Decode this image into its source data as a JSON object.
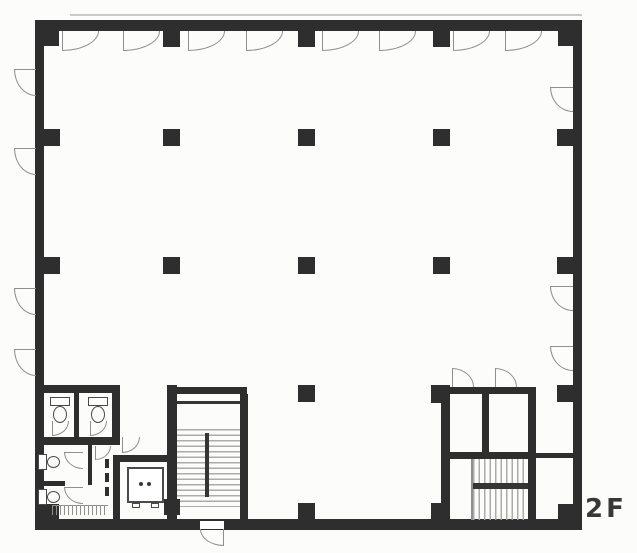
{
  "floor_label": "2F",
  "drawing": {
    "type": "architectural-floor-plan",
    "floor_name": "2F (second floor)",
    "features": [
      "open-office-area",
      "column-grid",
      "window-swing-arcs",
      "toilet-block",
      "elevator",
      "central-stairwell-with-exit",
      "rear-stair-core"
    ]
  },
  "colors": {
    "wall": "#2e2e2e",
    "dark": "#353535",
    "line": "#8f8f8f",
    "faint": "#c9c9c9",
    "tread": "#ababab",
    "white": "#ffffff"
  },
  "plan": {
    "elements": [
      {
        "t": "line",
        "name": "parapet-line",
        "x": 70,
        "y": 14,
        "w": 512,
        "h": 2,
        "c": "faint"
      },
      {
        "t": "rect",
        "name": "wall-top",
        "x": 35,
        "y": 20,
        "w": 547,
        "h": 11
      },
      {
        "t": "rect",
        "name": "wall-left",
        "x": 35,
        "y": 20,
        "w": 9,
        "h": 510
      },
      {
        "t": "rect",
        "name": "wall-right",
        "x": 573,
        "y": 20,
        "w": 9,
        "h": 510
      },
      {
        "t": "rect",
        "name": "wall-bottom",
        "x": 35,
        "y": 519,
        "w": 547,
        "h": 11
      },
      {
        "t": "rect",
        "name": "column-corner-nw",
        "x": 44,
        "y": 31,
        "w": 15,
        "h": 15
      },
      {
        "t": "rect",
        "name": "column-corner-ne",
        "x": 558,
        "y": 31,
        "w": 15,
        "h": 15
      },
      {
        "t": "rect",
        "name": "column-corner-sw",
        "x": 44,
        "y": 504,
        "w": 15,
        "h": 15
      },
      {
        "t": "rect",
        "name": "column-corner-se",
        "x": 558,
        "y": 504,
        "w": 15,
        "h": 15
      },
      {
        "t": "rect",
        "name": "column-top-1",
        "x": 163,
        "y": 31,
        "w": 17,
        "h": 16
      },
      {
        "t": "rect",
        "name": "column-top-2",
        "x": 298,
        "y": 31,
        "w": 17,
        "h": 16
      },
      {
        "t": "rect",
        "name": "column-top-3",
        "x": 433,
        "y": 31,
        "w": 17,
        "h": 16
      },
      {
        "t": "rect",
        "name": "column-left-1",
        "x": 44,
        "y": 129,
        "w": 16,
        "h": 17
      },
      {
        "t": "rect",
        "name": "column-left-2",
        "x": 44,
        "y": 257,
        "w": 16,
        "h": 17
      },
      {
        "t": "rect",
        "name": "column-right-1",
        "x": 557,
        "y": 129,
        "w": 16,
        "h": 17
      },
      {
        "t": "rect",
        "name": "column-right-2",
        "x": 557,
        "y": 257,
        "w": 16,
        "h": 17
      },
      {
        "t": "rect",
        "name": "column-right-3",
        "x": 557,
        "y": 385,
        "w": 16,
        "h": 17
      },
      {
        "t": "rect",
        "name": "column-bottom-1",
        "x": 298,
        "y": 503,
        "w": 17,
        "h": 16
      },
      {
        "t": "rect",
        "name": "column-interior",
        "x": 163,
        "y": 129,
        "w": 17,
        "h": 17
      },
      {
        "t": "rect",
        "name": "column-interior",
        "x": 298,
        "y": 129,
        "w": 17,
        "h": 17
      },
      {
        "t": "rect",
        "name": "column-interior",
        "x": 433,
        "y": 129,
        "w": 17,
        "h": 17
      },
      {
        "t": "rect",
        "name": "column-interior",
        "x": 163,
        "y": 257,
        "w": 17,
        "h": 17
      },
      {
        "t": "rect",
        "name": "column-interior",
        "x": 298,
        "y": 257,
        "w": 17,
        "h": 17
      },
      {
        "t": "rect",
        "name": "column-interior",
        "x": 433,
        "y": 257,
        "w": 17,
        "h": 17
      },
      {
        "t": "rect",
        "name": "column-interior",
        "x": 298,
        "y": 385,
        "w": 17,
        "h": 17
      },
      {
        "t": "arc",
        "name": "window-arc-top",
        "corner": "br",
        "leaf": "left",
        "x": 62,
        "y": 31,
        "w": 37,
        "h": 20
      },
      {
        "t": "arc",
        "name": "window-arc-top",
        "corner": "br",
        "leaf": "left",
        "x": 123,
        "y": 31,
        "w": 37,
        "h": 20
      },
      {
        "t": "arc",
        "name": "window-arc-top",
        "corner": "br",
        "leaf": "left",
        "x": 188,
        "y": 31,
        "w": 37,
        "h": 20
      },
      {
        "t": "arc",
        "name": "window-arc-top",
        "corner": "br",
        "leaf": "left",
        "x": 246,
        "y": 31,
        "w": 37,
        "h": 20
      },
      {
        "t": "arc",
        "name": "window-arc-top",
        "corner": "br",
        "leaf": "left",
        "x": 322,
        "y": 31,
        "w": 37,
        "h": 20
      },
      {
        "t": "arc",
        "name": "window-arc-top",
        "corner": "br",
        "leaf": "left",
        "x": 379,
        "y": 31,
        "w": 37,
        "h": 20
      },
      {
        "t": "arc",
        "name": "window-arc-top",
        "corner": "br",
        "leaf": "left",
        "x": 453,
        "y": 31,
        "w": 37,
        "h": 20
      },
      {
        "t": "arc",
        "name": "window-arc-top",
        "corner": "br",
        "leaf": "left",
        "x": 505,
        "y": 31,
        "w": 37,
        "h": 20
      },
      {
        "t": "arc",
        "name": "window-arc-left",
        "corner": "bl",
        "leaf": "top",
        "x": 14,
        "y": 69,
        "w": 22,
        "h": 27
      },
      {
        "t": "arc",
        "name": "window-arc-left",
        "corner": "bl",
        "leaf": "top",
        "x": 14,
        "y": 148,
        "w": 22,
        "h": 27
      },
      {
        "t": "arc",
        "name": "window-arc-left",
        "corner": "bl",
        "leaf": "top",
        "x": 14,
        "y": 288,
        "w": 22,
        "h": 27
      },
      {
        "t": "arc",
        "name": "window-arc-left",
        "corner": "bl",
        "leaf": "top",
        "x": 14,
        "y": 349,
        "w": 22,
        "h": 27
      },
      {
        "t": "arc",
        "name": "window-arc-right",
        "corner": "bl",
        "leaf": "top",
        "x": 550,
        "y": 87,
        "w": 23,
        "h": 25
      },
      {
        "t": "arc",
        "name": "window-arc-right",
        "corner": "bl",
        "leaf": "top",
        "x": 550,
        "y": 286,
        "w": 23,
        "h": 25
      },
      {
        "t": "arc",
        "name": "window-arc-right",
        "corner": "bl",
        "leaf": "top",
        "x": 550,
        "y": 346,
        "w": 23,
        "h": 25
      },
      {
        "t": "rect",
        "name": "stair-wall-left",
        "x": 167,
        "y": 385,
        "w": 10,
        "h": 145
      },
      {
        "t": "rect",
        "name": "stair-wall-top",
        "x": 177,
        "y": 387,
        "w": 70,
        "h": 7
      },
      {
        "t": "rect",
        "name": "stair-wall-right",
        "x": 240,
        "y": 394,
        "w": 8,
        "h": 136
      },
      {
        "t": "rect",
        "name": "stair-landing-edge",
        "x": 177,
        "y": 401,
        "w": 63,
        "h": 3,
        "c": "dark"
      },
      {
        "t": "hlines",
        "name": "stair-treads",
        "x": 177,
        "y": 429,
        "w": 63,
        "h": 78
      },
      {
        "t": "rect",
        "name": "stair-center-rail",
        "x": 205,
        "y": 433,
        "w": 4,
        "h": 64,
        "c": "dark"
      },
      {
        "t": "rect",
        "name": "column-stair-sw",
        "x": 164,
        "y": 499,
        "w": 16,
        "h": 16
      },
      {
        "t": "rect",
        "name": "exit-door-opening",
        "x": 200,
        "y": 521,
        "w": 24,
        "h": 8,
        "c": "white"
      },
      {
        "t": "arc",
        "name": "exit-door-arc",
        "corner": "bl",
        "leaf": "right",
        "x": 200,
        "y": 529,
        "w": 24,
        "h": 17
      },
      {
        "t": "rect",
        "name": "elevator-wall-top",
        "x": 113,
        "y": 455,
        "w": 54,
        "h": 7
      },
      {
        "t": "rect",
        "name": "elevator-wall-left",
        "x": 113,
        "y": 455,
        "w": 7,
        "h": 75
      },
      {
        "t": "box",
        "name": "elevator-car",
        "x": 127,
        "y": 467,
        "w": 37,
        "h": 36,
        "bw": 2
      },
      {
        "t": "dot",
        "name": "elevator-dot",
        "x": 139,
        "y": 482,
        "w": 4,
        "h": 4
      },
      {
        "t": "dot",
        "name": "elevator-dot",
        "x": 147,
        "y": 482,
        "w": 4,
        "h": 4
      },
      {
        "t": "box",
        "name": "elevator-door-jamb",
        "x": 132,
        "y": 503,
        "w": 8,
        "h": 5
      },
      {
        "t": "box",
        "name": "elevator-door-jamb",
        "x": 151,
        "y": 503,
        "w": 8,
        "h": 5
      },
      {
        "t": "arc",
        "name": "elevator-lobby-door",
        "corner": "br",
        "leaf": "left",
        "x": 122,
        "y": 437,
        "w": 18,
        "h": 16
      },
      {
        "t": "rect",
        "name": "toilet-wall-top",
        "x": 35,
        "y": 385,
        "w": 85,
        "h": 8
      },
      {
        "t": "rect",
        "name": "toilet-wall-right",
        "x": 112,
        "y": 385,
        "w": 8,
        "h": 60
      },
      {
        "t": "rect",
        "name": "toilet-stall-divider",
        "x": 74,
        "y": 393,
        "w": 5,
        "h": 44
      },
      {
        "t": "rect",
        "name": "toilet-wall-mid",
        "x": 35,
        "y": 437,
        "w": 85,
        "h": 8
      },
      {
        "t": "box",
        "name": "toilet-tank",
        "x": 50,
        "y": 397,
        "w": 20,
        "h": 9
      },
      {
        "t": "ellipse",
        "name": "toilet-bowl",
        "x": 53,
        "y": 406,
        "w": 14,
        "h": 17
      },
      {
        "t": "box",
        "name": "toilet-tank",
        "x": 88,
        "y": 397,
        "w": 20,
        "h": 9
      },
      {
        "t": "ellipse",
        "name": "toilet-bowl",
        "x": 91,
        "y": 406,
        "w": 14,
        "h": 17
      },
      {
        "t": "arc",
        "name": "stall-door-arc",
        "corner": "br",
        "leaf": "left",
        "x": 52,
        "y": 421,
        "w": 17,
        "h": 15
      },
      {
        "t": "arc",
        "name": "stall-door-arc",
        "corner": "br",
        "leaf": "left",
        "x": 90,
        "y": 421,
        "w": 17,
        "h": 15
      },
      {
        "t": "rect",
        "name": "wc-divider",
        "x": 35,
        "y": 481,
        "w": 30,
        "h": 5
      },
      {
        "t": "box",
        "name": "wc-fixture-tank",
        "x": 38,
        "y": 454,
        "w": 9,
        "h": 16
      },
      {
        "t": "ellipse",
        "name": "wc-fixture-bowl",
        "x": 47,
        "y": 456,
        "w": 13,
        "h": 12
      },
      {
        "t": "box",
        "name": "wc-fixture-tank",
        "x": 38,
        "y": 489,
        "w": 9,
        "h": 16
      },
      {
        "t": "ellipse",
        "name": "wc-fixture-bowl",
        "x": 47,
        "y": 491,
        "w": 13,
        "h": 12
      },
      {
        "t": "arc",
        "name": "wc-door-arc",
        "corner": "bl",
        "leaf": "top",
        "x": 64,
        "y": 452,
        "w": 19,
        "h": 17
      },
      {
        "t": "arc",
        "name": "wc-door-arc",
        "corner": "bl",
        "leaf": "top",
        "x": 64,
        "y": 487,
        "w": 19,
        "h": 17
      },
      {
        "t": "rect",
        "name": "toilet-partition",
        "x": 88,
        "y": 445,
        "w": 4,
        "h": 40
      },
      {
        "t": "rect",
        "name": "partition-dash",
        "x": 105,
        "y": 459,
        "w": 4,
        "h": 9
      },
      {
        "t": "rect",
        "name": "partition-dash",
        "x": 105,
        "y": 473,
        "w": 4,
        "h": 9
      },
      {
        "t": "rect",
        "name": "partition-dash",
        "x": 105,
        "y": 487,
        "w": 4,
        "h": 9
      },
      {
        "t": "arc",
        "name": "toilet-lobby-door",
        "corner": "br",
        "leaf": "left",
        "x": 95,
        "y": 446,
        "w": 16,
        "h": 14
      },
      {
        "t": "ticks",
        "name": "sink-counter",
        "x": 52,
        "y": 505,
        "w": 56,
        "h": 10
      },
      {
        "t": "rect",
        "name": "core-wall-top",
        "x": 437,
        "y": 387,
        "w": 99,
        "h": 7
      },
      {
        "t": "rect",
        "name": "column-core-nw",
        "x": 431,
        "y": 385,
        "w": 19,
        "h": 18
      },
      {
        "t": "rect",
        "name": "core-wall-left",
        "x": 441,
        "y": 394,
        "w": 9,
        "h": 136
      },
      {
        "t": "rect",
        "name": "core-room-divider",
        "x": 482,
        "y": 394,
        "w": 7,
        "h": 58
      },
      {
        "t": "rect",
        "name": "core-wall-right",
        "x": 528,
        "y": 387,
        "w": 8,
        "h": 143
      },
      {
        "t": "rect",
        "name": "core-wall-mid",
        "x": 441,
        "y": 452,
        "w": 95,
        "h": 7
      },
      {
        "t": "rect",
        "name": "corridor-wall",
        "x": 536,
        "y": 453,
        "w": 37,
        "h": 5
      },
      {
        "t": "vlines",
        "name": "rear-stair-treads",
        "x": 473,
        "y": 459,
        "w": 55,
        "h": 61
      },
      {
        "t": "rect",
        "name": "rear-stair-landing-bar",
        "x": 473,
        "y": 483,
        "w": 55,
        "h": 6,
        "c": "dark"
      },
      {
        "t": "rect",
        "name": "rear-stair-edge",
        "x": 471,
        "y": 459,
        "w": 2,
        "h": 61,
        "c": "line"
      },
      {
        "t": "rect",
        "name": "column-core-sw",
        "x": 431,
        "y": 503,
        "w": 19,
        "h": 17
      },
      {
        "t": "arc",
        "name": "core-door-arc",
        "corner": "tr",
        "leaf": "left",
        "x": 452,
        "y": 368,
        "w": 22,
        "h": 19
      },
      {
        "t": "arc",
        "name": "core-door-arc",
        "corner": "tr",
        "leaf": "left",
        "x": 495,
        "y": 368,
        "w": 22,
        "h": 19
      }
    ]
  }
}
